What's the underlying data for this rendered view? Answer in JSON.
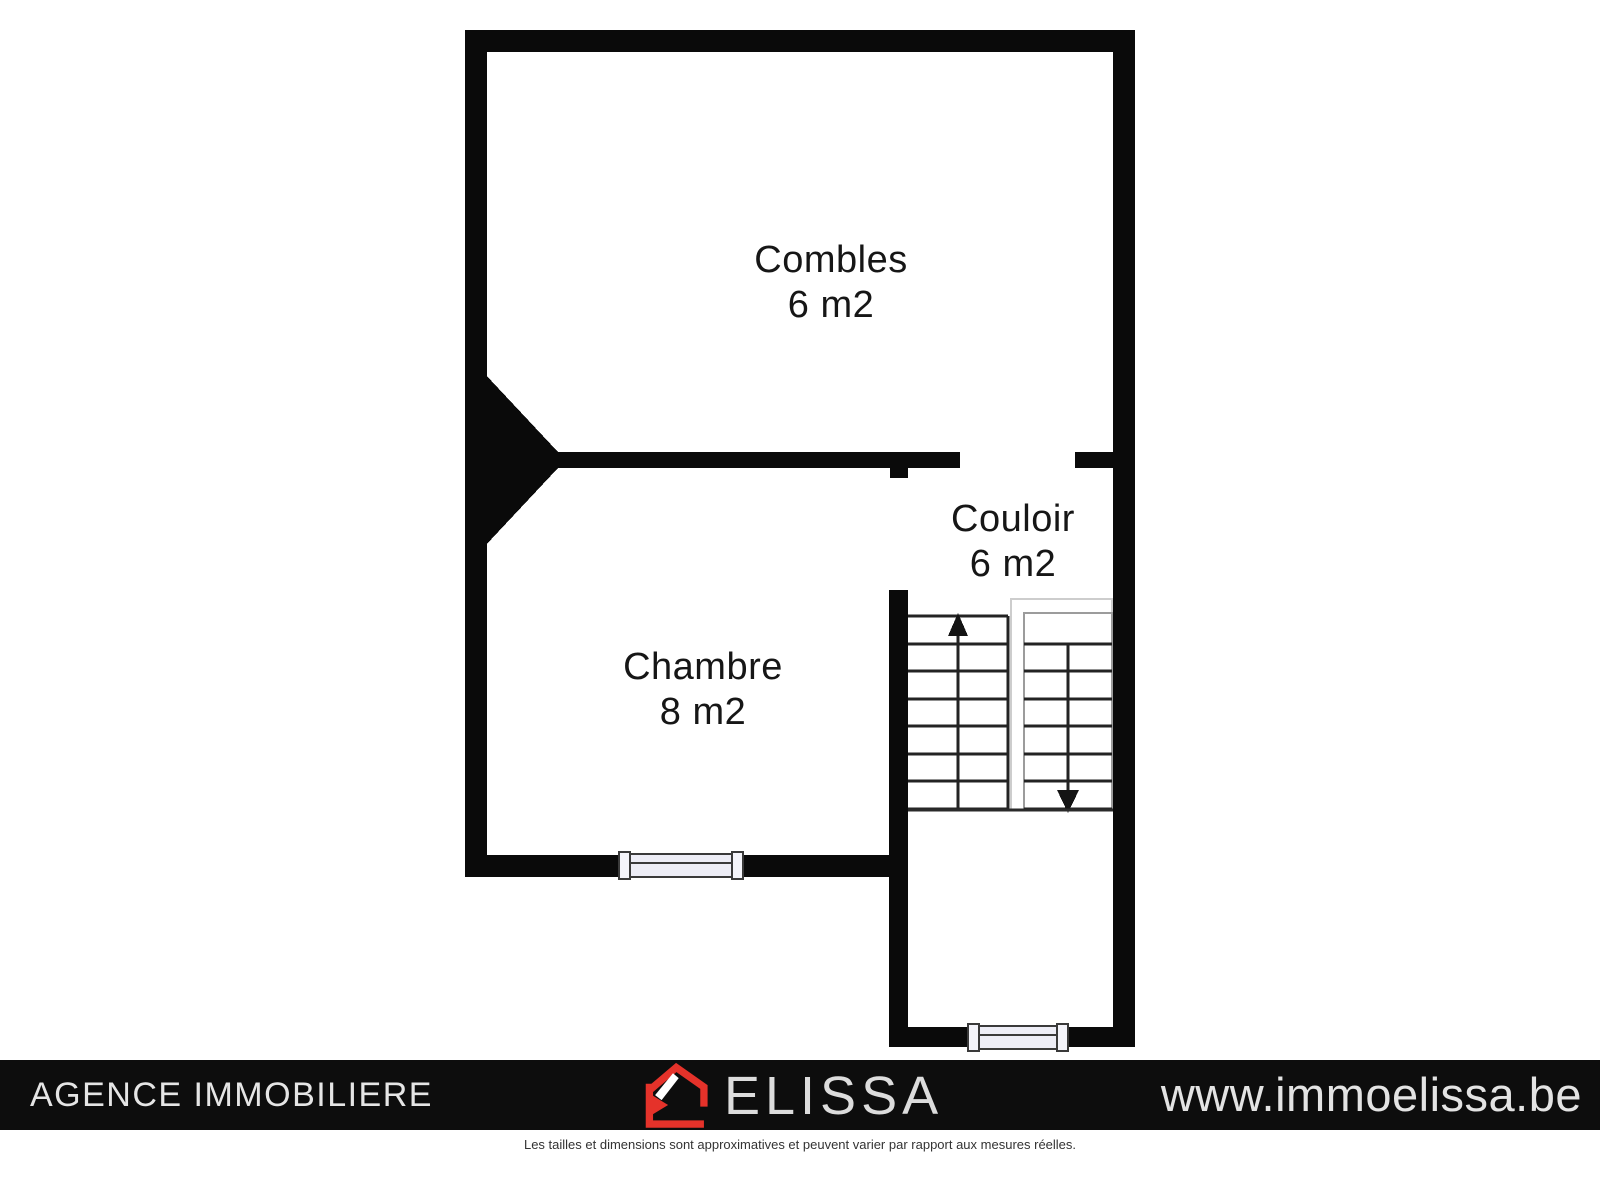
{
  "plan": {
    "rooms": [
      {
        "name": "Combles",
        "area": "6 m2"
      },
      {
        "name": "Chambre",
        "area": "8 m2"
      },
      {
        "name": "Couloir",
        "area": "6 m2"
      }
    ],
    "stairs": {
      "up_arrow": "stairs-up",
      "down_arrow": "stairs-down"
    }
  },
  "footer": {
    "agency_label": "AGENCE IMMOBILIERE",
    "brand_name": "ELISSA",
    "website": "www.immoelissa.be"
  },
  "disclaimer": "Les tailles et dimensions sont approximatives et peuvent varier par rapport aux mesures réelles.",
  "colors": {
    "wall": "#0a0a0a",
    "footer_bar": "#0d0d0d",
    "brand_red": "#e5322a",
    "footer_text": "#e3e3e3",
    "window_fill": "#ededf6",
    "stair_line": "#232323"
  }
}
